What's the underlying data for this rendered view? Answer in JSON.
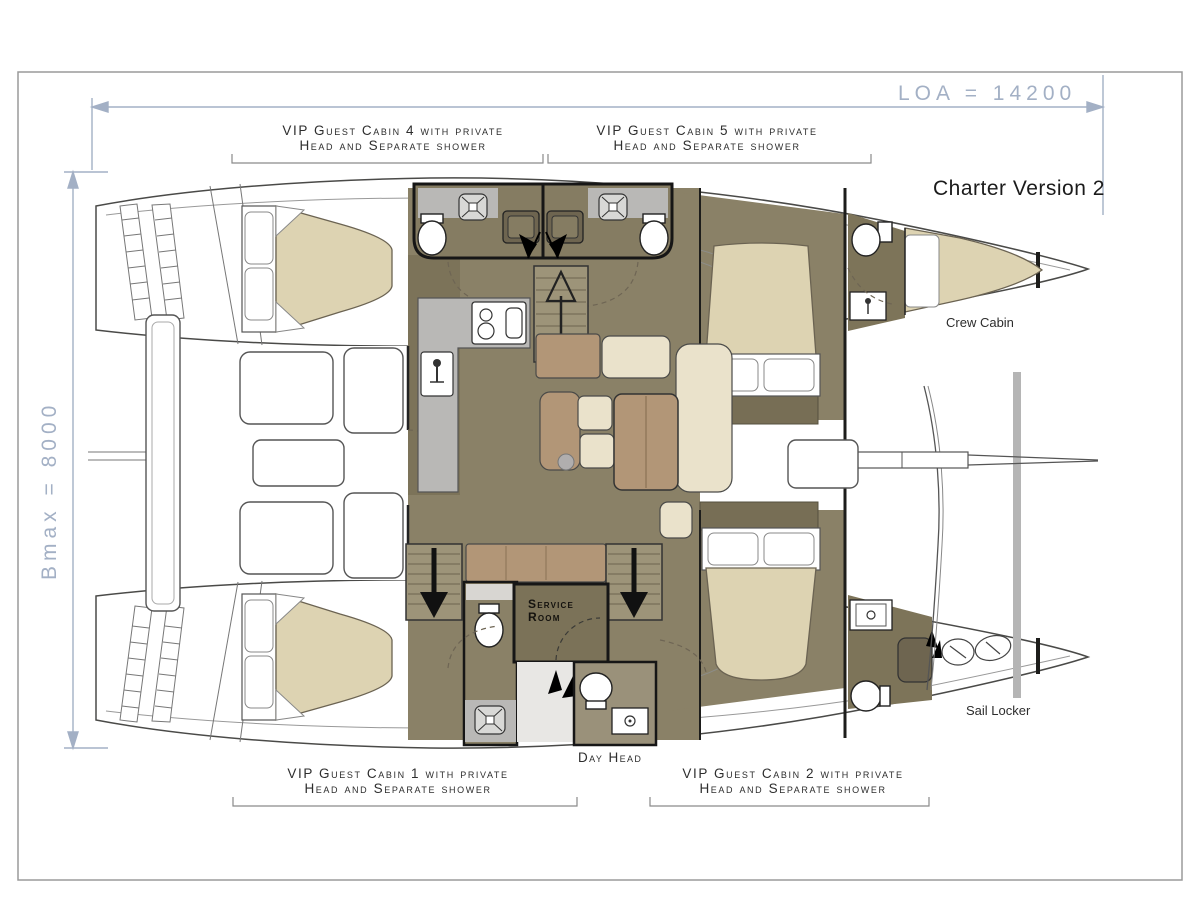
{
  "dimensions": {
    "loa_label": "LOA = 14200",
    "bmax_label": "Bmax = 8000"
  },
  "title_block": {
    "version_label": "Charter Version 2"
  },
  "cabin_labels": {
    "cabin4_line1": "VIP Guest Cabin 4 with private",
    "cabin4_line2": "Head and Separate shower",
    "cabin5_line1": "VIP Guest Cabin 5 with private",
    "cabin5_line2": "Head and Separate shower",
    "cabin1_line1": "VIP Guest Cabin 1 with private",
    "cabin1_line2": "Head and Separate shower",
    "cabin2_line1": "VIP Guest Cabin 2 with private",
    "cabin2_line2": "Head and Separate shower"
  },
  "room_labels": {
    "crew_cabin": "Crew Cabin",
    "sail_locker": "Sail Locker",
    "day_head": "Day Head",
    "service_room_line1": "Service",
    "service_room_line2": "Room"
  },
  "colors": {
    "dimension_blue": "#a3b0c5",
    "wall_dark": "#1d1d1b",
    "floor_olive": "#8a8167",
    "floor_dark_olive": "#6f6750",
    "bed_beige": "#ddd3b2",
    "upholstery_cream": "#eae2cb",
    "wood_brown": "#b29677",
    "counter_gray": "#b9b8b6",
    "outline_gray": "#5a5a58"
  }
}
